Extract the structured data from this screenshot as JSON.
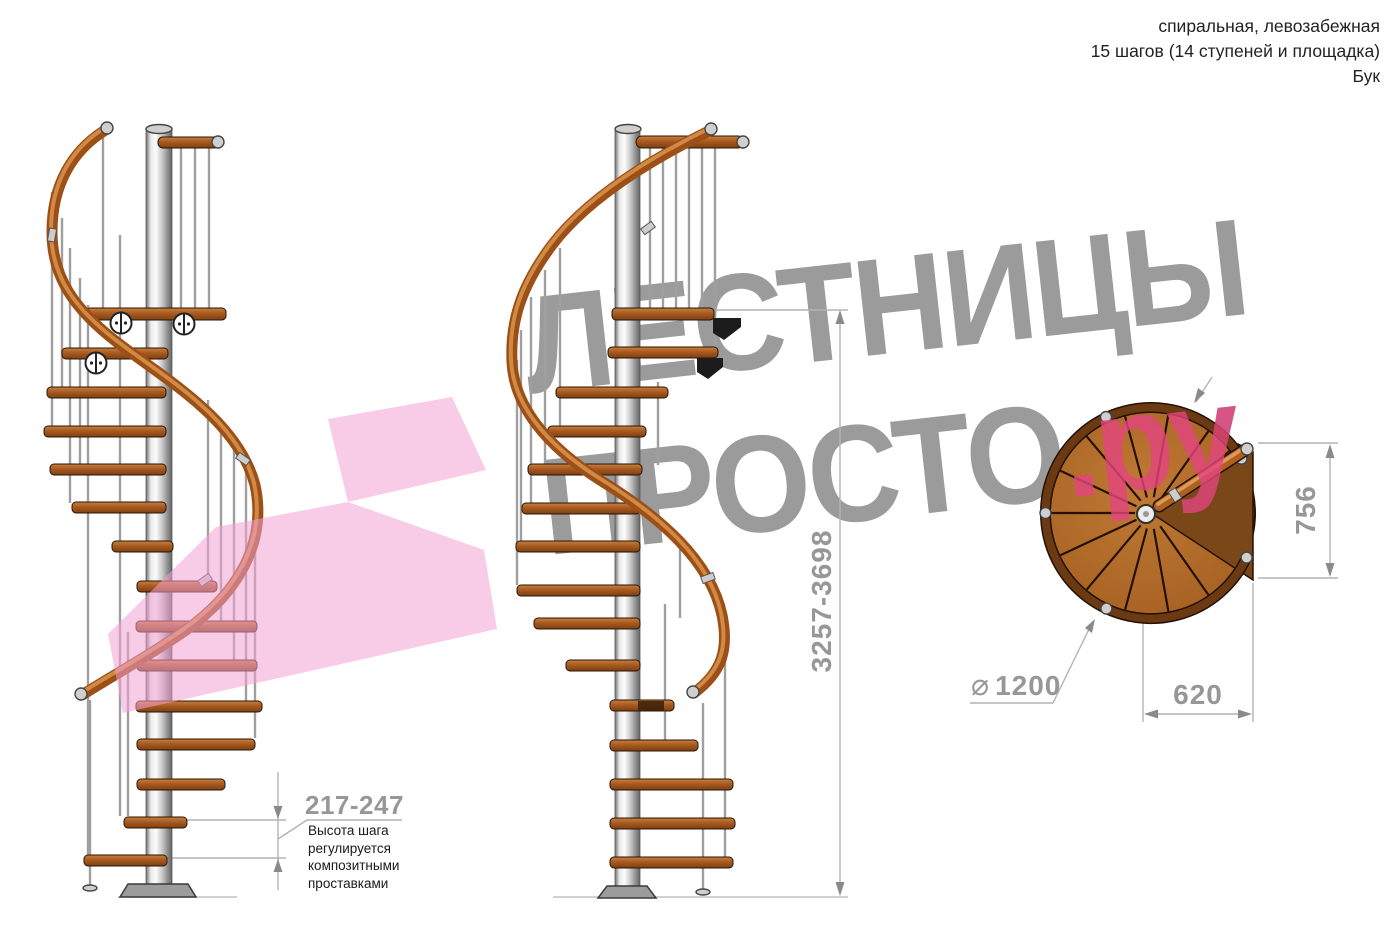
{
  "colors": {
    "wood": "#b06a28",
    "wood-dark": "#7a4718",
    "rail": "#9c4f16",
    "rail-light": "#d08a44",
    "step-top": "#c8803e",
    "step-bottom": "#7c3f12",
    "metal": "#d9d9d9",
    "dim-text": "#979797",
    "dim-line": "#b3b3b3",
    "watermark-gray": "#9b9b9b",
    "watermark-pink": "#e4457f",
    "pink-shape": "#f2a0d2"
  },
  "header": {
    "type_line": "спиральная, левозабежная",
    "steps_line": "15 шагов (14 ступеней и площадка)",
    "material_line": "Бук"
  },
  "watermark": {
    "line1": "ЛЕСТНИЦЫ",
    "line2_main": "ПРОСТО",
    "line2_accent": ".ру"
  },
  "dimensions": {
    "total_height": {
      "value": "3257-3698"
    },
    "step_height": {
      "value": "217-247",
      "note": "Высота шага\nрегулируется\nкомпозитными\nпроставками"
    },
    "diameter": {
      "symbol": "⌀",
      "value": "1200"
    },
    "landing_depth": {
      "value": "756"
    },
    "landing_width": {
      "value": "620"
    }
  }
}
